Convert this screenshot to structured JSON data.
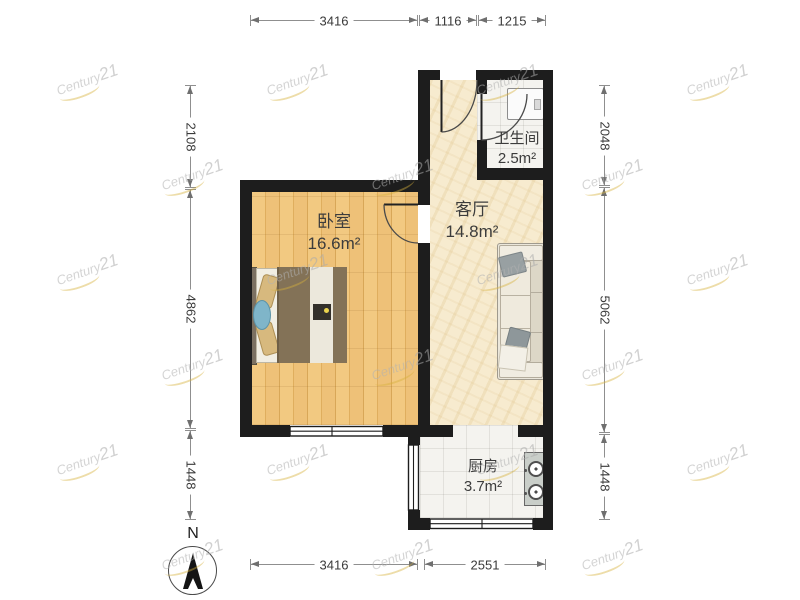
{
  "watermark": {
    "brand": "Century",
    "number": "21"
  },
  "compass": {
    "label": "N"
  },
  "rooms": {
    "bedroom": {
      "name": "卧室",
      "area": "16.6m²"
    },
    "living": {
      "name": "客厅",
      "area": "14.8m²"
    },
    "bathroom": {
      "name": "卫生间",
      "area": "2.5m²"
    },
    "kitchen": {
      "name": "厨房",
      "area": "3.7m²"
    }
  },
  "dimensions": {
    "top": [
      "3416",
      "1116",
      "1215"
    ],
    "bottom": [
      "3416",
      "2551"
    ],
    "left": [
      "2108",
      "4862",
      "1448"
    ],
    "right": [
      "2048",
      "5062",
      "1448"
    ]
  },
  "colors": {
    "wall": "#1d1d1d",
    "wood_floor": "#f0c77e",
    "marble_floor": "#f7ebcf",
    "tile_floor": "#f4f3ef",
    "dimension_line": "#8f8f8f",
    "watermark_gold": "#d6b03c"
  }
}
